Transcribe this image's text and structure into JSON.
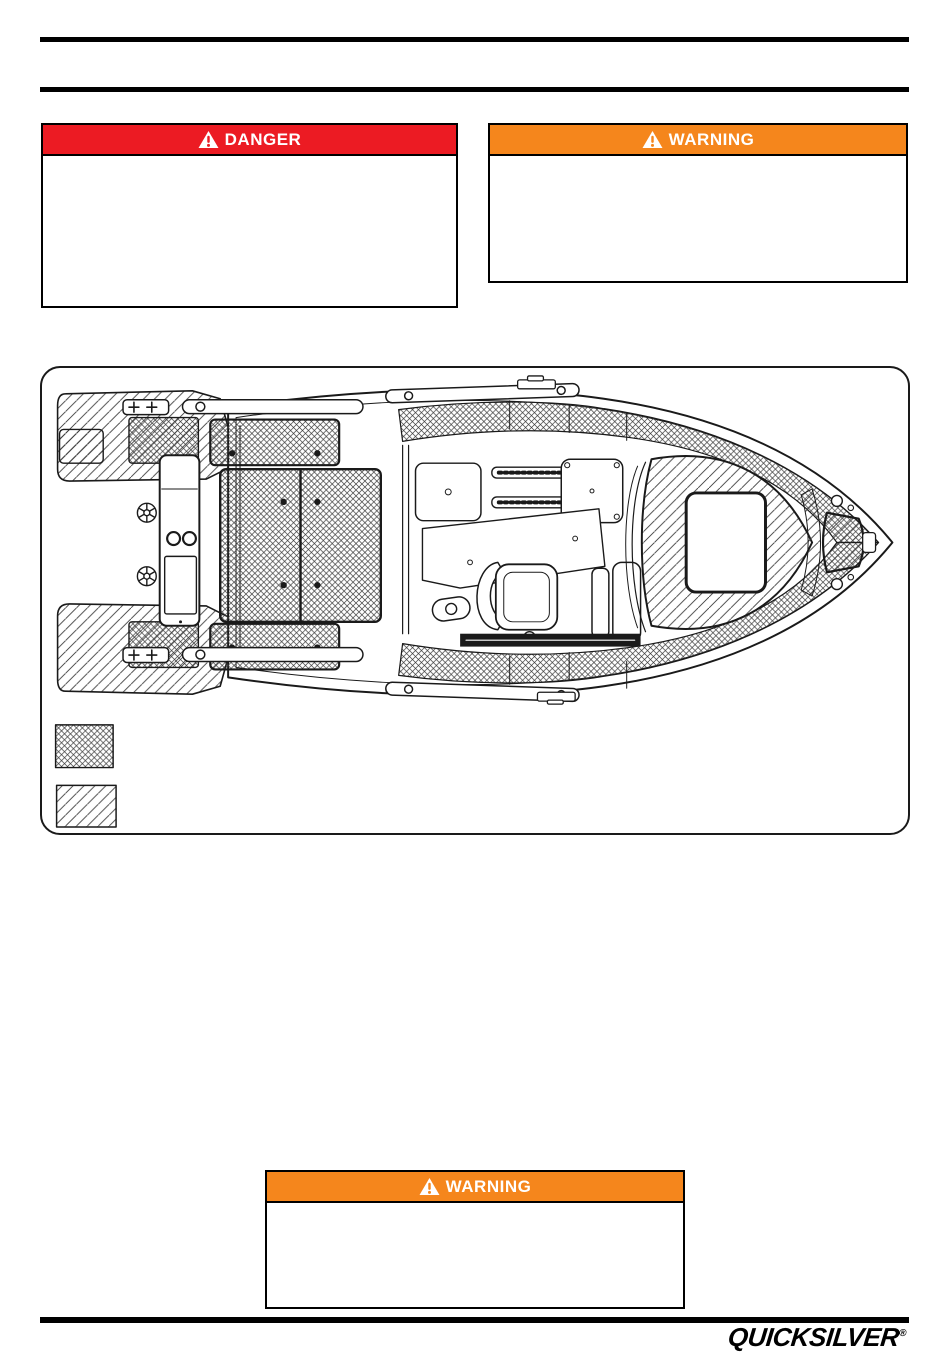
{
  "page_type": "boat-owners-manual-page",
  "rules": {
    "color": "#000000"
  },
  "boxes": {
    "danger": {
      "label": "DANGER",
      "header_color": "#EC1B23",
      "text_color": "#ffffff",
      "body_text": ""
    },
    "warning_top": {
      "label": "WARNING",
      "header_color": "#F5861C",
      "text_color": "#ffffff",
      "body_text": ""
    },
    "warning_bottom": {
      "label": "WARNING",
      "header_color": "#F5861C",
      "text_color": "#ffffff",
      "body_text": ""
    }
  },
  "figure": {
    "description": "Top-view technical line drawing of a pilothouse boat; crosshatched areas mark deck tread surfaces, diagonal-hatched areas mark platforms and hatches",
    "legend": [
      {
        "swatch": "crosshatch-pattern",
        "label": ""
      },
      {
        "swatch": "diagonal-hatch-pattern",
        "label": ""
      }
    ]
  },
  "footer": {
    "brand": "QUICKSILVER",
    "reg": "®"
  }
}
